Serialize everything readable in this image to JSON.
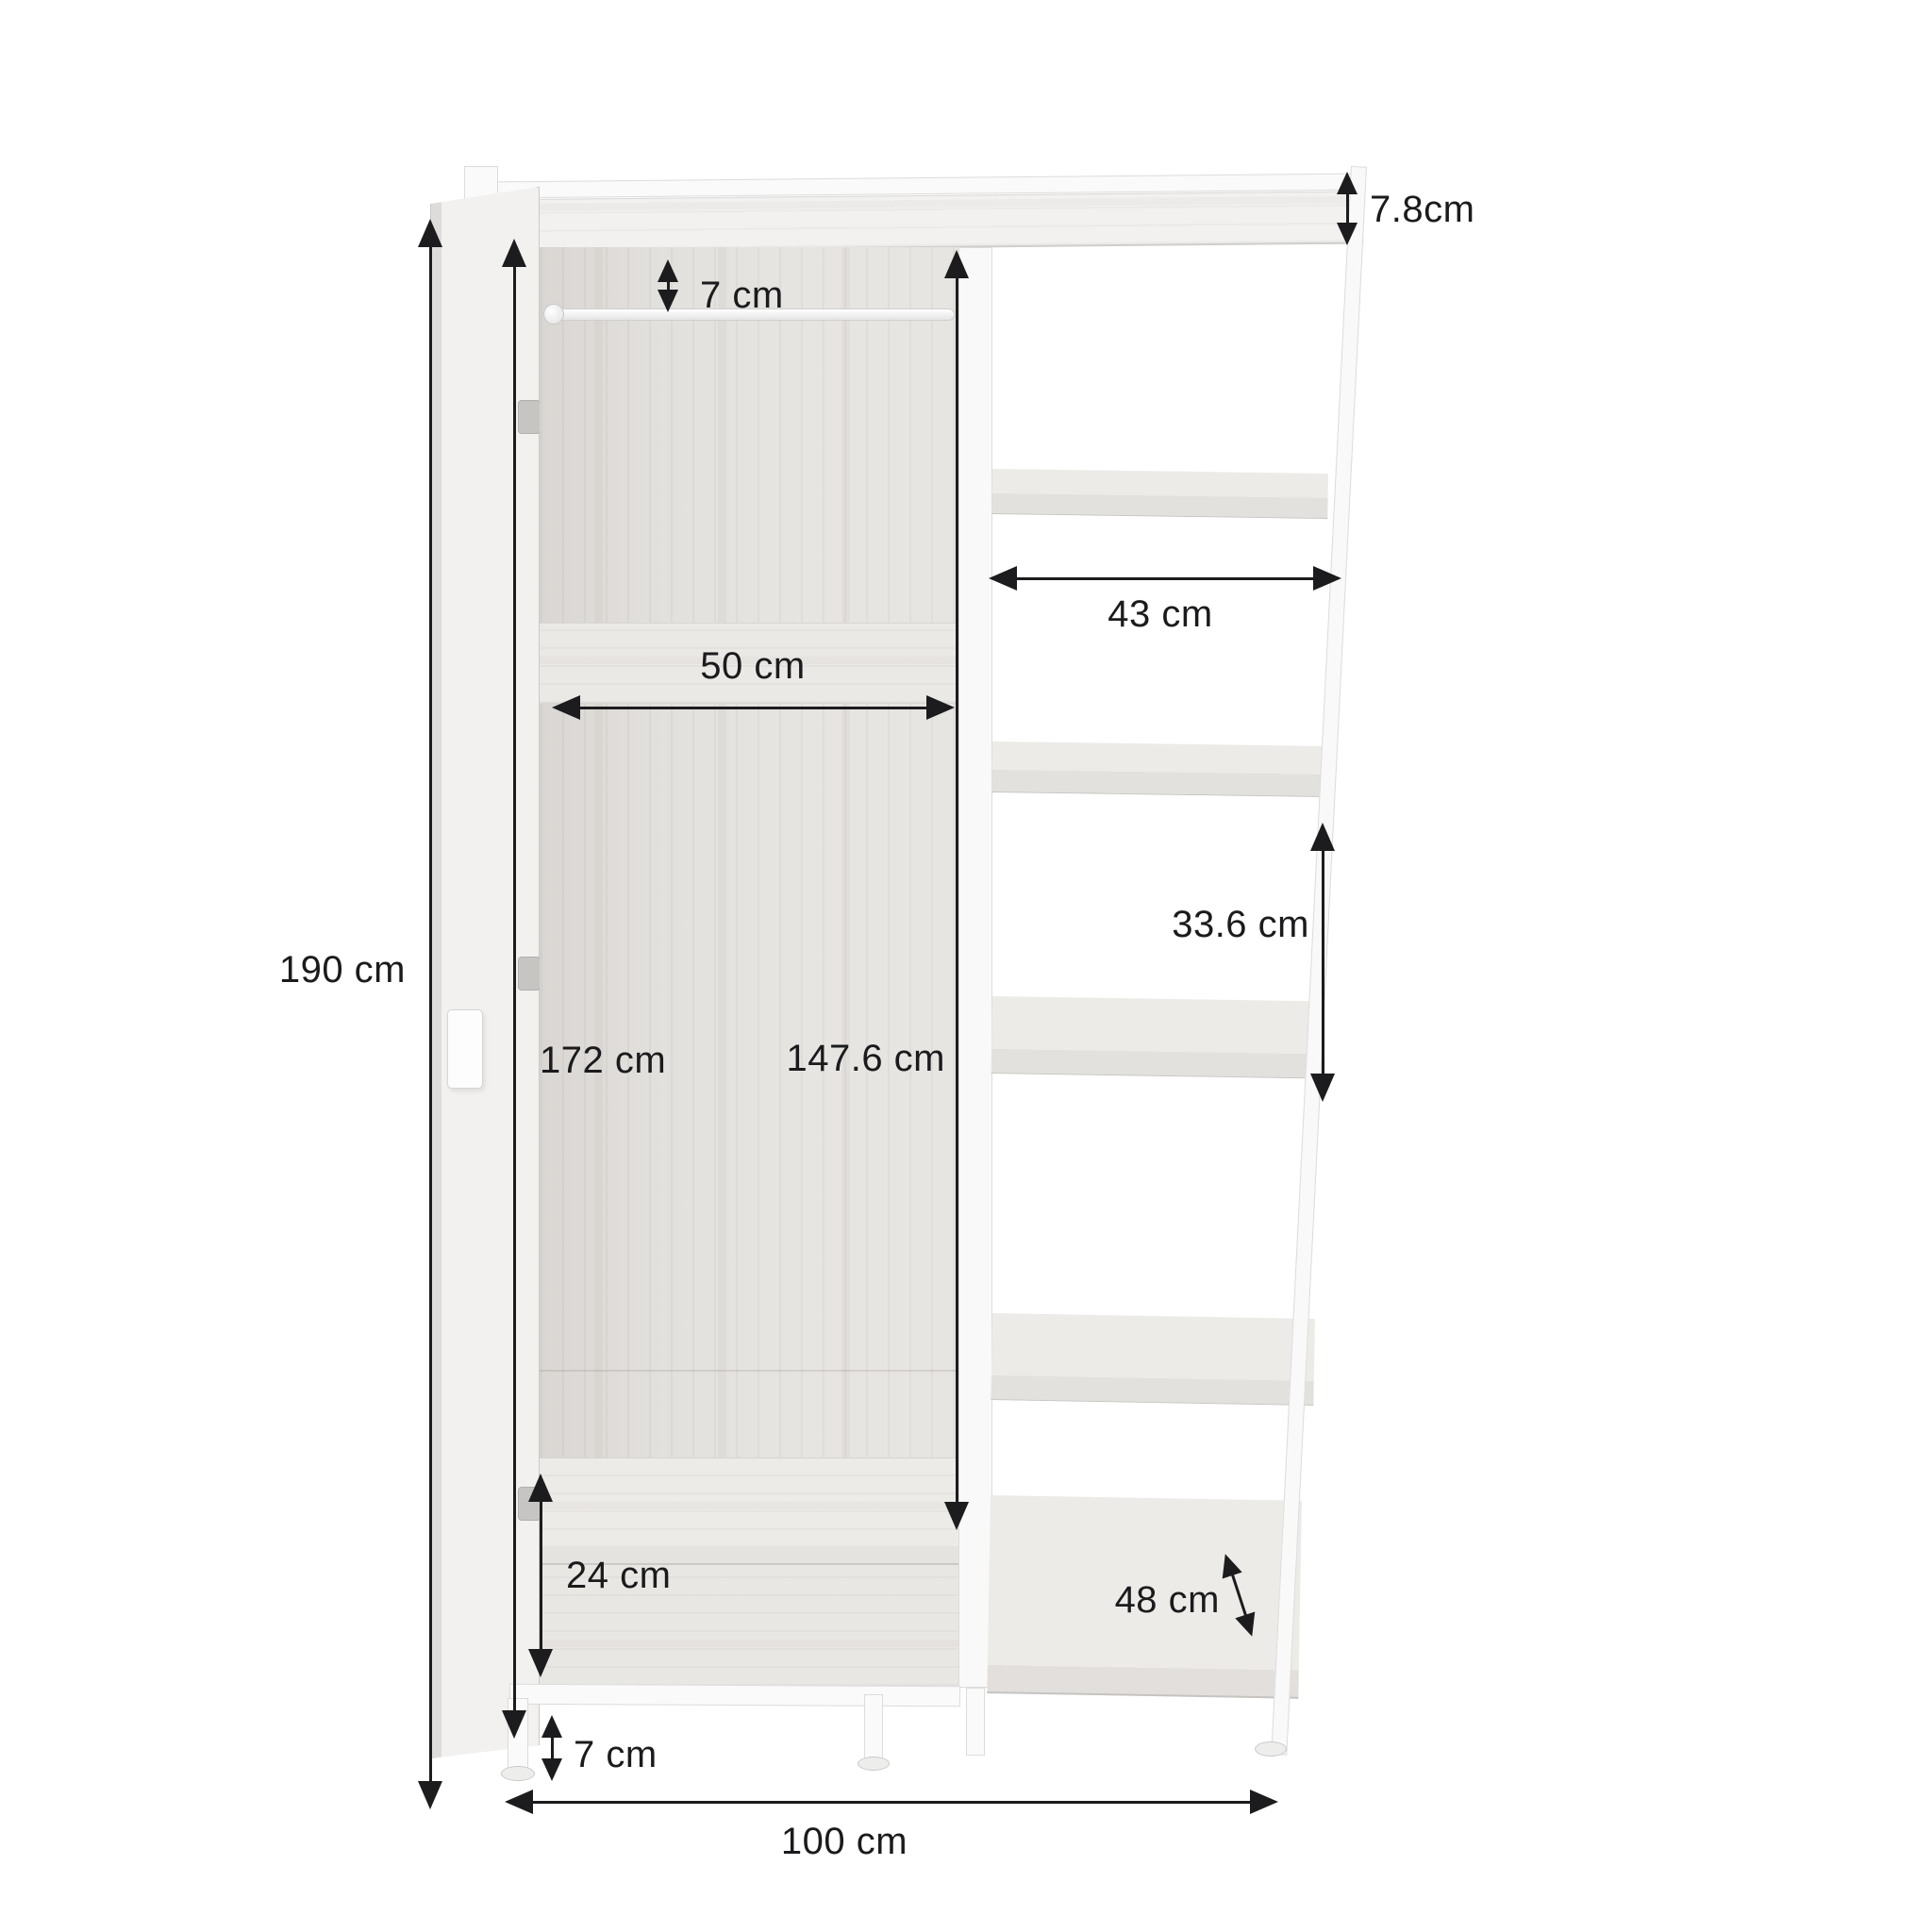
{
  "diagram": {
    "type": "furniture-dimension-diagram",
    "subject": "open wardrobe with side shelving unit",
    "unit": "cm",
    "dimensions": {
      "total_height": "190 cm",
      "door_height": "172 cm",
      "interior_height": "147.6 cm",
      "interior_width": "50 cm",
      "rail_gap": "7 cm",
      "top_frame_height": "7.8cm",
      "shelf_width": "43 cm",
      "shelf_spacing": "33.6 cm",
      "bottom_compartment_height": "24 cm",
      "leg_height": "7 cm",
      "shelf_depth": "48 cm",
      "total_width": "100 cm"
    }
  }
}
